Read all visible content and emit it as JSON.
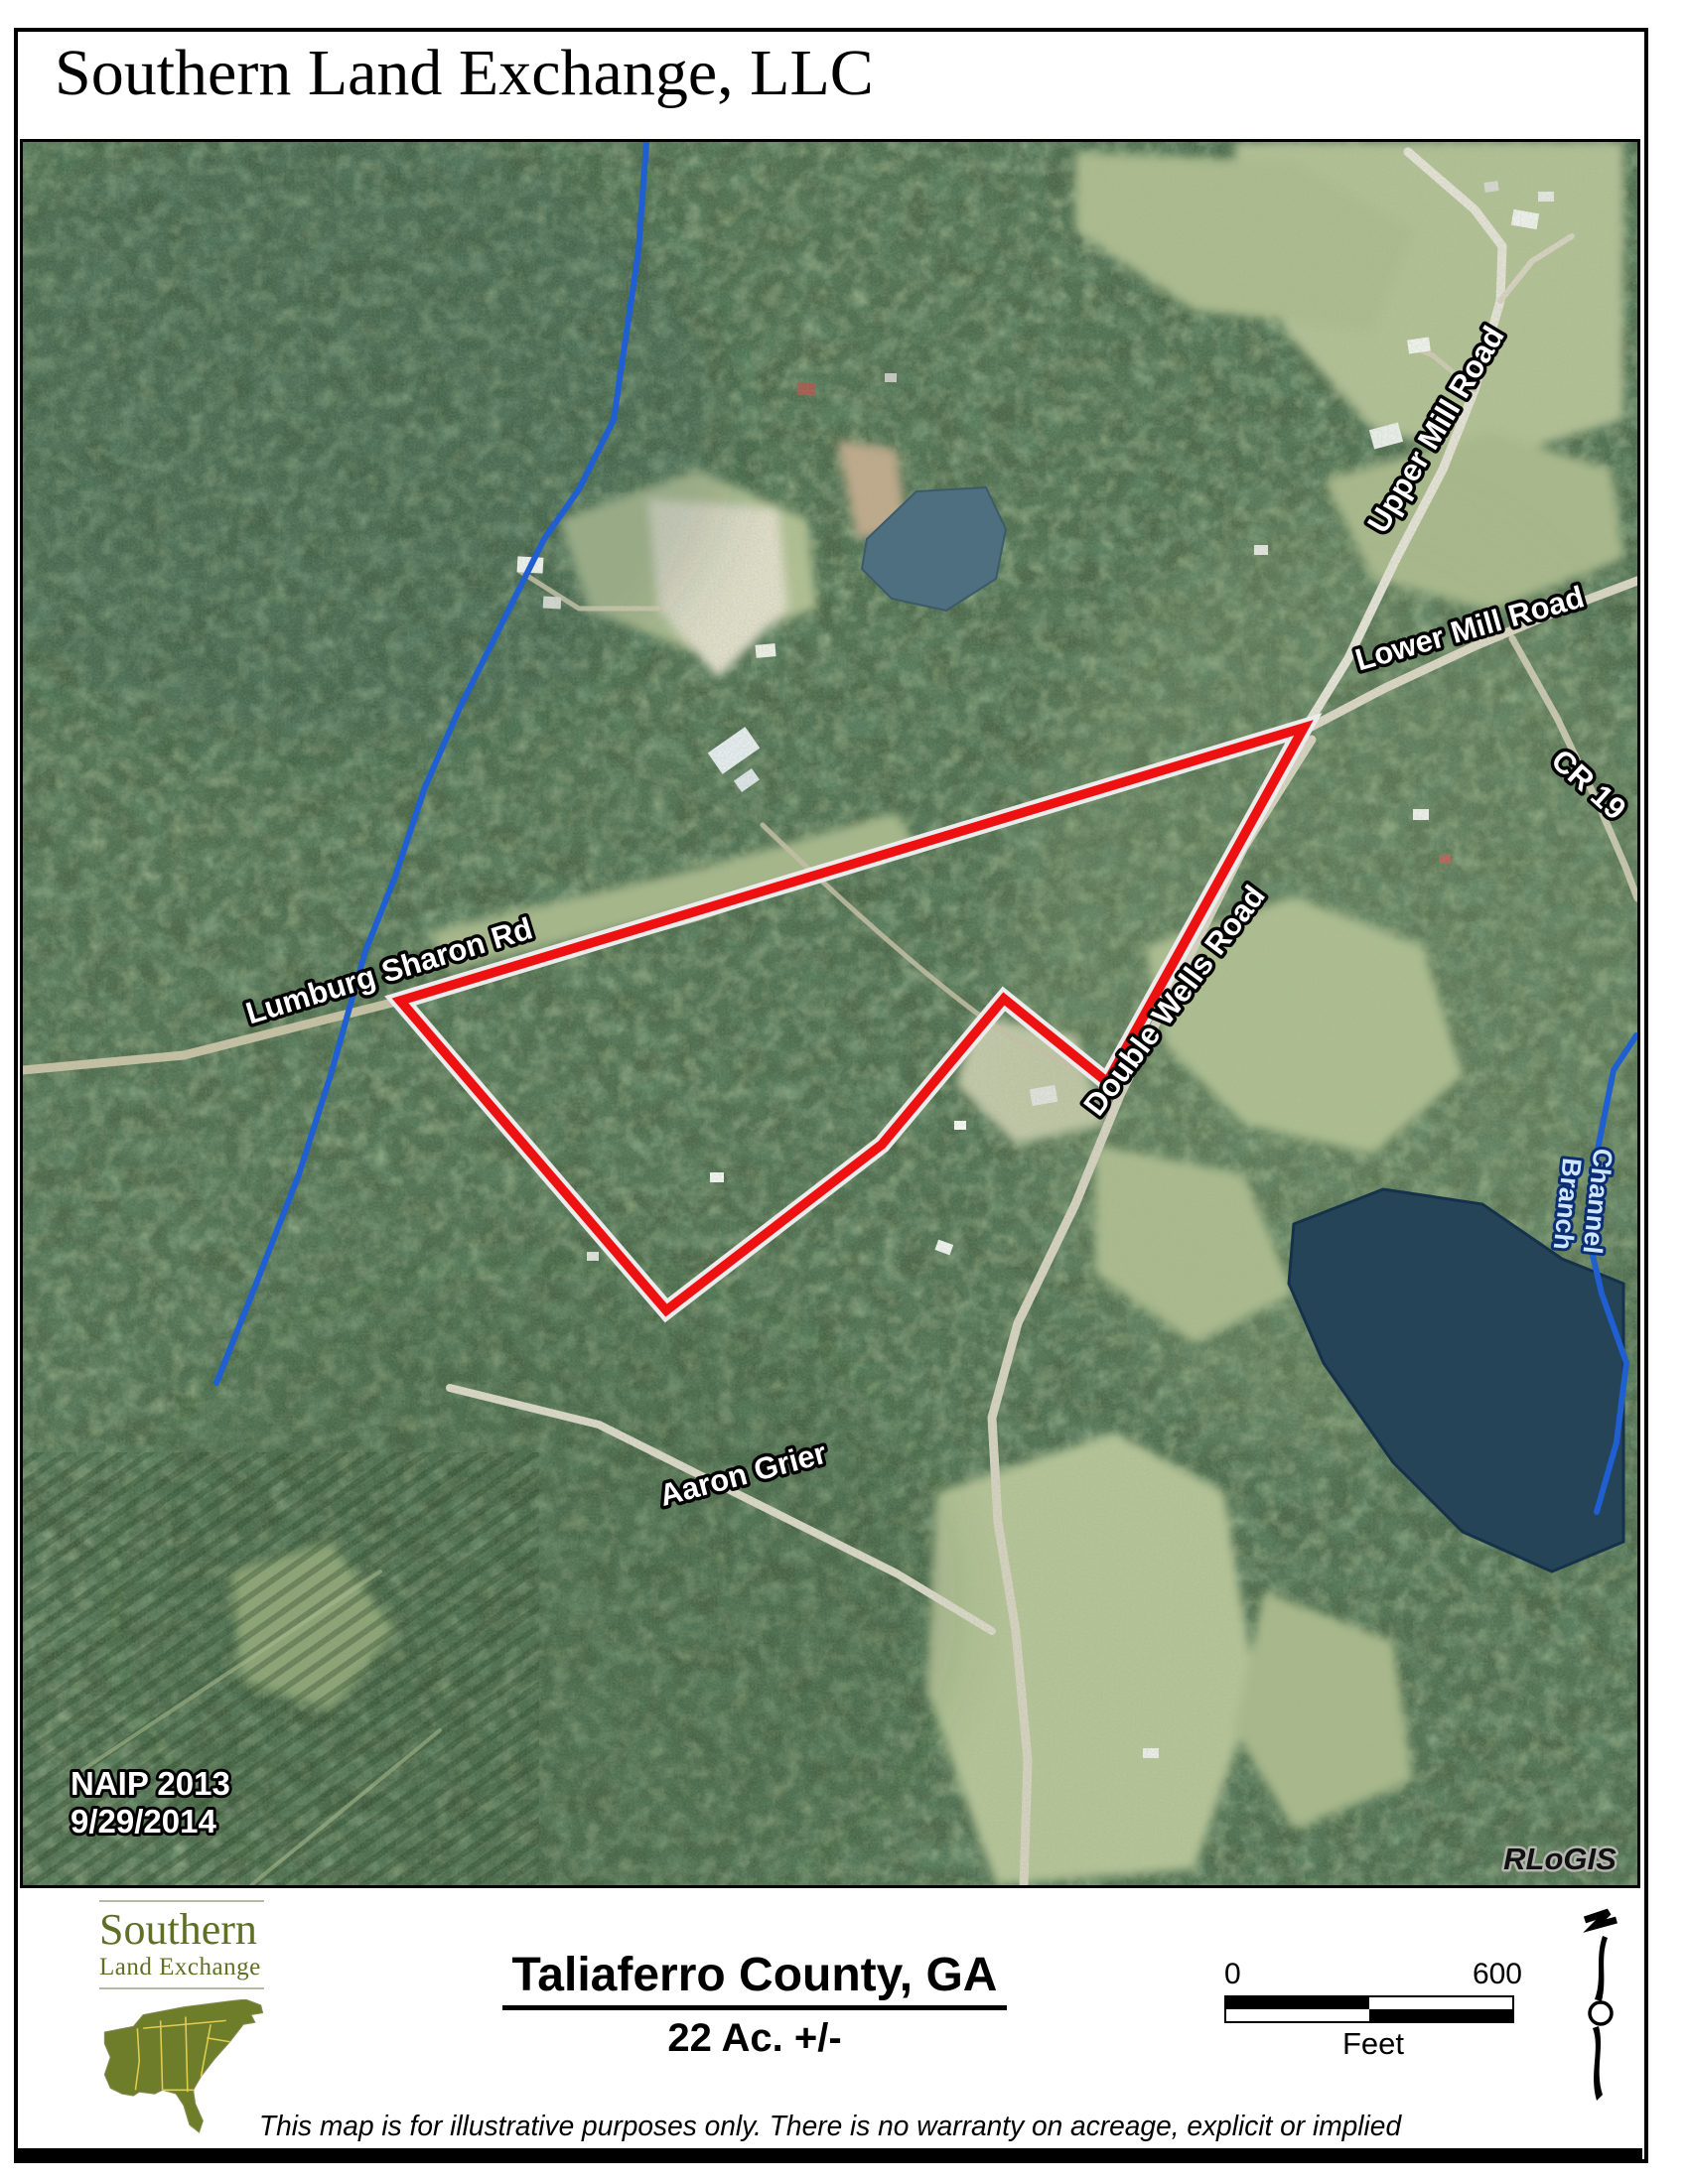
{
  "header": {
    "company": "Southern Land Exchange, LLC"
  },
  "map": {
    "labels": {
      "upper_mill": "Upper Mill Road",
      "lower_mill": "Lower Mill Road",
      "cr19": "CR 19",
      "lumburg": "Lumburg Sharon Rd",
      "double_wells": "Double Wells Road",
      "aaron_grier": "Aaron Grier",
      "channel_line1": "Channel",
      "channel_line2": "Branch"
    },
    "credits": {
      "naip_line1": "NAIP 2013",
      "naip_line2": "9/29/2014",
      "gis": "RLoGIS"
    },
    "boundary_color": "#ee1111",
    "water_color": "#1f5fd2"
  },
  "footer": {
    "logo_line1": "Southern",
    "logo_line2": "Land Exchange",
    "logo_color": "#5f7026",
    "county_title": "Taliaferro County, GA",
    "acreage": "22 Ac. +/-",
    "scale": {
      "start": "0",
      "end": "600",
      "unit": "Feet"
    },
    "disclaimer": "This map is for illustrative purposes only.  There is no warranty on acreage, explicit or implied"
  }
}
